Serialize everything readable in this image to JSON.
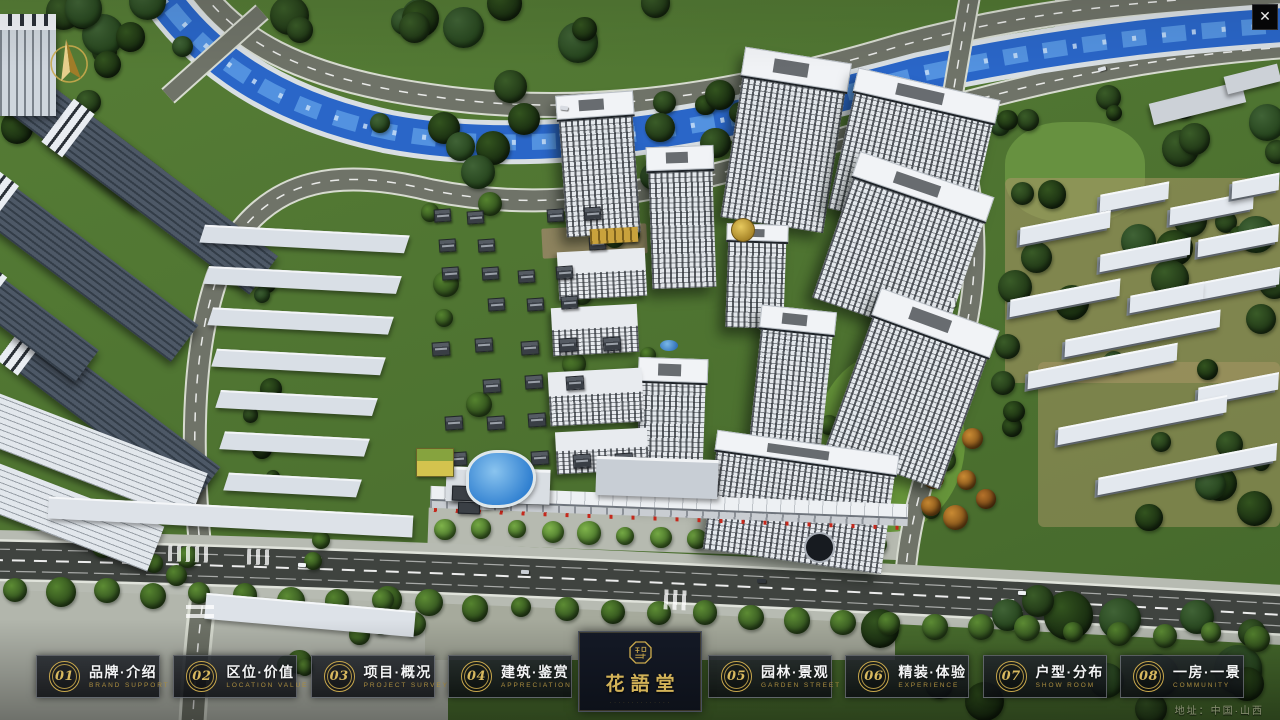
{
  "app": {
    "close_glyph": "✕"
  },
  "logo": {
    "title": "花語堂",
    "subtitle": "· · · · · · · · · · · · · ·"
  },
  "nav": {
    "items": [
      {
        "num": "01",
        "label": "品牌·介绍",
        "caption": "BRAND SUPPORT"
      },
      {
        "num": "02",
        "label": "区位·价值",
        "caption": "LOCATION VALUE"
      },
      {
        "num": "03",
        "label": "项目·概况",
        "caption": "PROJECT SURVEY"
      },
      {
        "num": "04",
        "label": "建筑·鉴赏",
        "caption": "APPRECIATION"
      },
      {
        "num": "05",
        "label": "园林·景观",
        "caption": "GARDEN STREET"
      },
      {
        "num": "06",
        "label": "精装·体验",
        "caption": "EXPERIENCE"
      },
      {
        "num": "07",
        "label": "户型·分布",
        "caption": "SHOW ROOM"
      },
      {
        "num": "08",
        "label": "一房·一景",
        "caption": "COMMUNITY"
      }
    ]
  },
  "footer": {
    "address": "地址：中国·山西"
  },
  "scene_colors": {
    "river": "#2a66c8",
    "asphalt": "#3f433f",
    "grass": "#4d7230",
    "gold_accent": "#c9a84c"
  }
}
